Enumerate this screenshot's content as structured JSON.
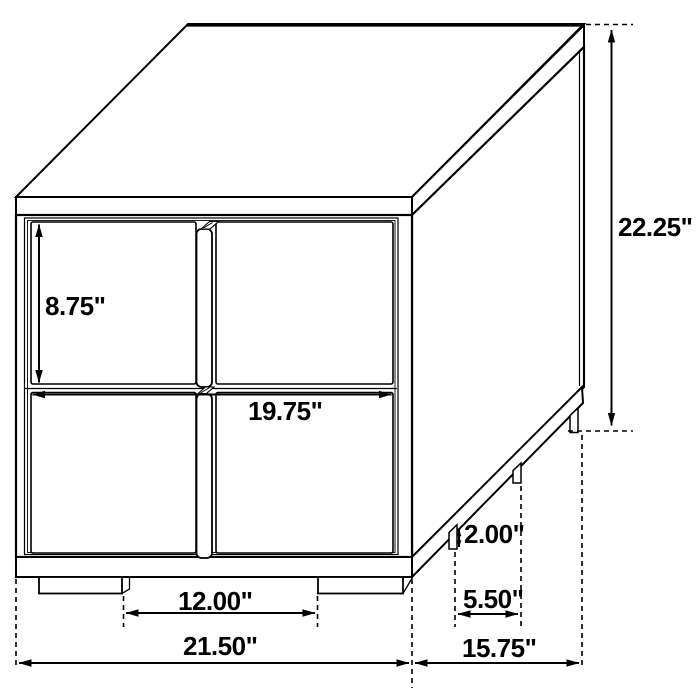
{
  "diagram": {
    "subject": "nightstand-2-drawer-dimension-diagram",
    "unit": "inches",
    "line_color": "#000000",
    "background_color": "#ffffff",
    "dimensions": {
      "overall_height": "22.25\"",
      "overall_width": "21.50\"",
      "overall_depth": "15.75\"",
      "drawer_front_height": "8.75\"",
      "drawer_front_width": "19.75\"",
      "leg_height": "2.00\"",
      "side_leg_spacing": "5.50\"",
      "front_leg_spacing": "12.00\""
    }
  }
}
